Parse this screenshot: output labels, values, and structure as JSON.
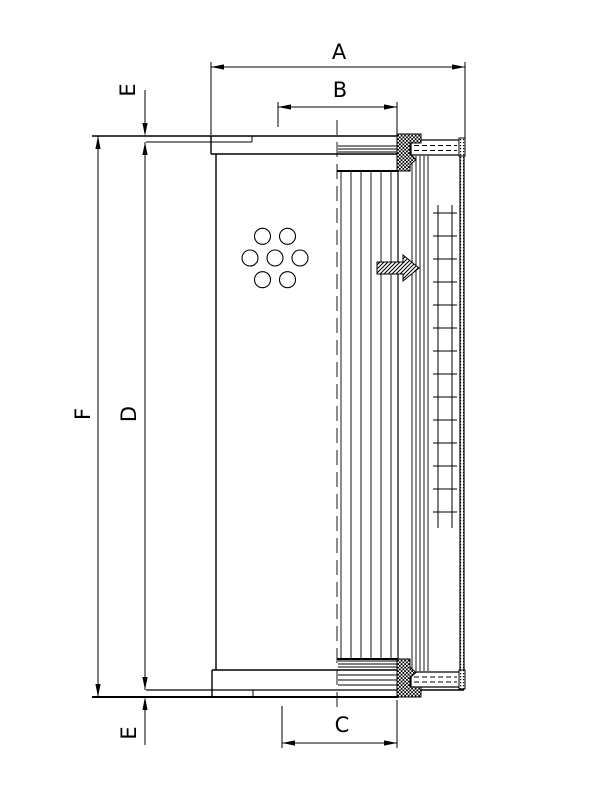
{
  "canvas": {
    "background": "#ffffff",
    "ink": "#000000",
    "description": "Dimensional line drawing of a cylindrical hydraulic filter element shown half in outside view, half in section"
  },
  "labels": {
    "a": "A",
    "b": "B",
    "c": "C",
    "d": "D",
    "f": "F",
    "e_top": "E",
    "e_bottom": "E"
  }
}
